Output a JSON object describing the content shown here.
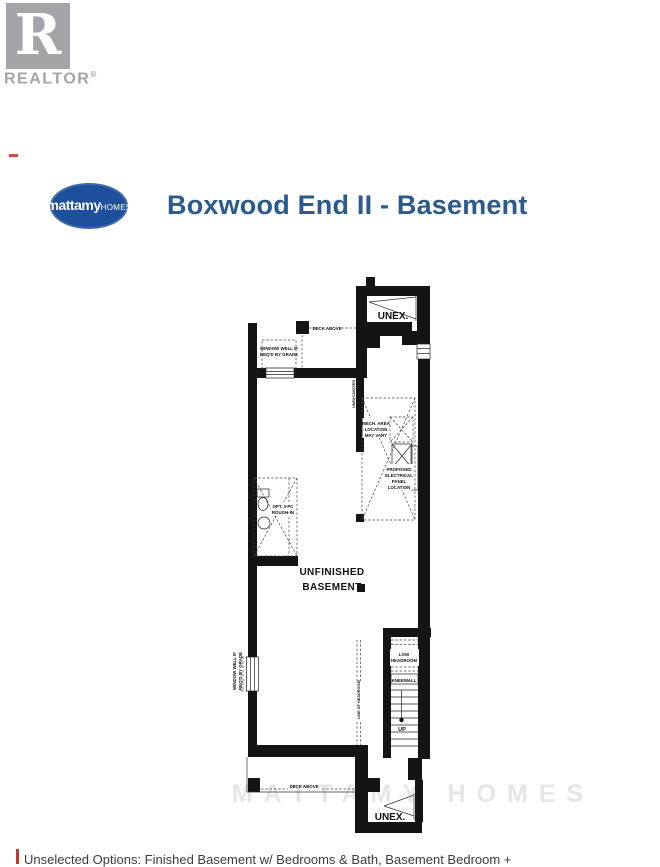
{
  "branding": {
    "realtor_r": "R",
    "realtor_wordmark": "REALTOR",
    "realtor_reg": "®",
    "mattamy_primary": "mattamy",
    "mattamy_secondary": "HOMES"
  },
  "header": {
    "title": "Boxwood End II - Basement"
  },
  "floorplan": {
    "labels": {
      "unex_top": "UNEX.",
      "unex_bottom": "UNEX.",
      "deck_above_top": "DECK ABOVE",
      "deck_above_bottom": "DECK ABOVE",
      "window_well_line1": "WINDOW WELL IF",
      "window_well_line2": "REQ'D BY GRADE",
      "window_well_side_line1": "WINDOW WELL IF",
      "window_well_side_line2": "REQ'D BY GRADE",
      "mech_line1": "MECH. AREA",
      "mech_line2": "LOCATION",
      "mech_line3": "MAY VARY",
      "elec_line1": "PROPOSED",
      "elec_line2": "ELECTRICAL",
      "elec_line3": "PANEL",
      "elec_line4": "LOCATION",
      "opt_bath_line1": "OPT. 3-PC",
      "opt_bath_line2": "ROUGH-IN",
      "room_line1": "UNFINISHED",
      "room_line2": "BASEMENT",
      "low_headroom_line1": "LOW",
      "low_headroom_line2": "HEADROOM",
      "kneewall": "KNEEWALL",
      "up": "UP",
      "line_of_headroom": "LINE OF HEADROOM",
      "unexcavated_side": "UNEXCAVATED"
    },
    "watermark": "MATTAMY HOMES"
  },
  "footer": {
    "disclaimer": "Unselected Options: Finished Basement w/ Bedrooms & Bath, Basement Bedroom +"
  },
  "colors": {
    "title_blue": "#2a5a8e",
    "logo_blue": "#1e4f9c",
    "realtor_gray": "#a2a4a7",
    "wall_black": "#141414",
    "margin_red": "#c0392b"
  }
}
